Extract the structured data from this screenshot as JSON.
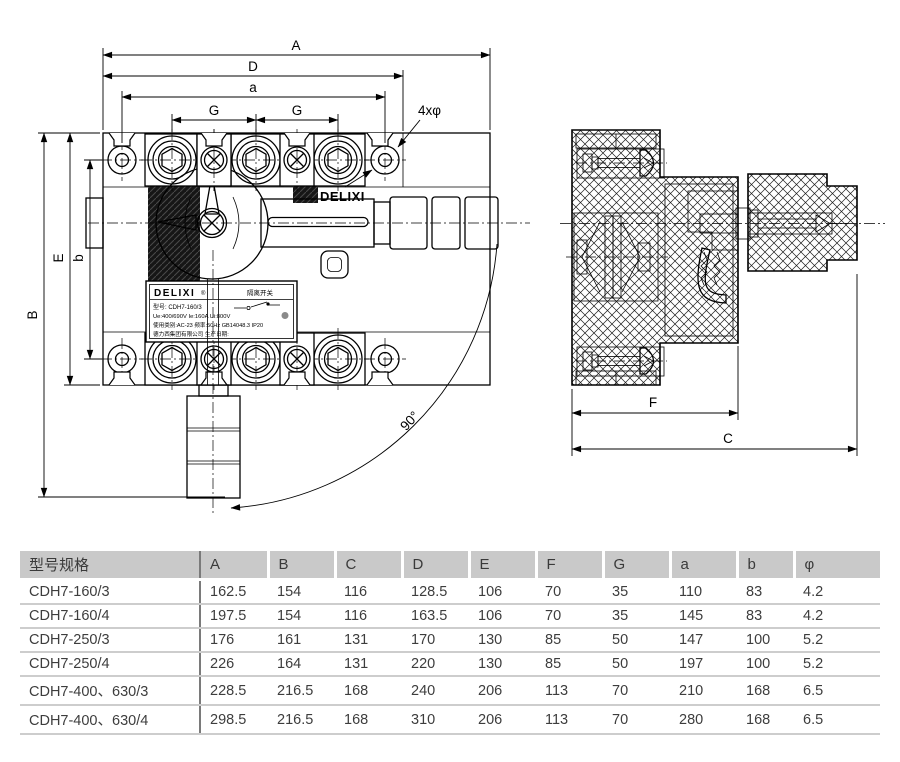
{
  "drawing": {
    "dim_labels": {
      "A": "A",
      "D": "D",
      "a": "a",
      "G": "G",
      "holes": "4xφ",
      "B": "B",
      "E": "E",
      "b": "b",
      "F": "F",
      "C": "C",
      "angle": "90°"
    },
    "brand_text": "DELIXI",
    "nameplate": {
      "brand": "DELIXI",
      "reg": "®",
      "product": "隔离开关",
      "model": "型号: CDH7-160/3",
      "ratings": "Ue:400/690V  Ie:160A  Ui:800V",
      "category": "使用类别:AC-23  频率:50Hz  GB14048.3  IP20",
      "company": "德力西集团有限公司  生产日期:"
    }
  },
  "table": {
    "columns": [
      "型号规格",
      "A",
      "B",
      "C",
      "D",
      "E",
      "F",
      "G",
      "a",
      "b",
      "φ"
    ],
    "rows": [
      [
        "CDH7-160/3",
        "162.5",
        "154",
        "116",
        "128.5",
        "106",
        "70",
        "35",
        "110",
        "83",
        "4.2"
      ],
      [
        "CDH7-160/4",
        "197.5",
        "154",
        "116",
        "163.5",
        "106",
        "70",
        "35",
        "145",
        "83",
        "4.2"
      ],
      [
        "CDH7-250/3",
        "176",
        "161",
        "131",
        "170",
        "130",
        "85",
        "50",
        "147",
        "100",
        "5.2"
      ],
      [
        "CDH7-250/4",
        "226",
        "164",
        "131",
        "220",
        "130",
        "85",
        "50",
        "197",
        "100",
        "5.2"
      ],
      [
        "CDH7-400、630/3",
        "228.5",
        "216.5",
        "168",
        "240",
        "206",
        "113",
        "70",
        "210",
        "168",
        "6.5"
      ],
      [
        "CDH7-400、630/4",
        "298.5",
        "216.5",
        "168",
        "310",
        "206",
        "113",
        "70",
        "280",
        "168",
        "6.5"
      ]
    ]
  }
}
